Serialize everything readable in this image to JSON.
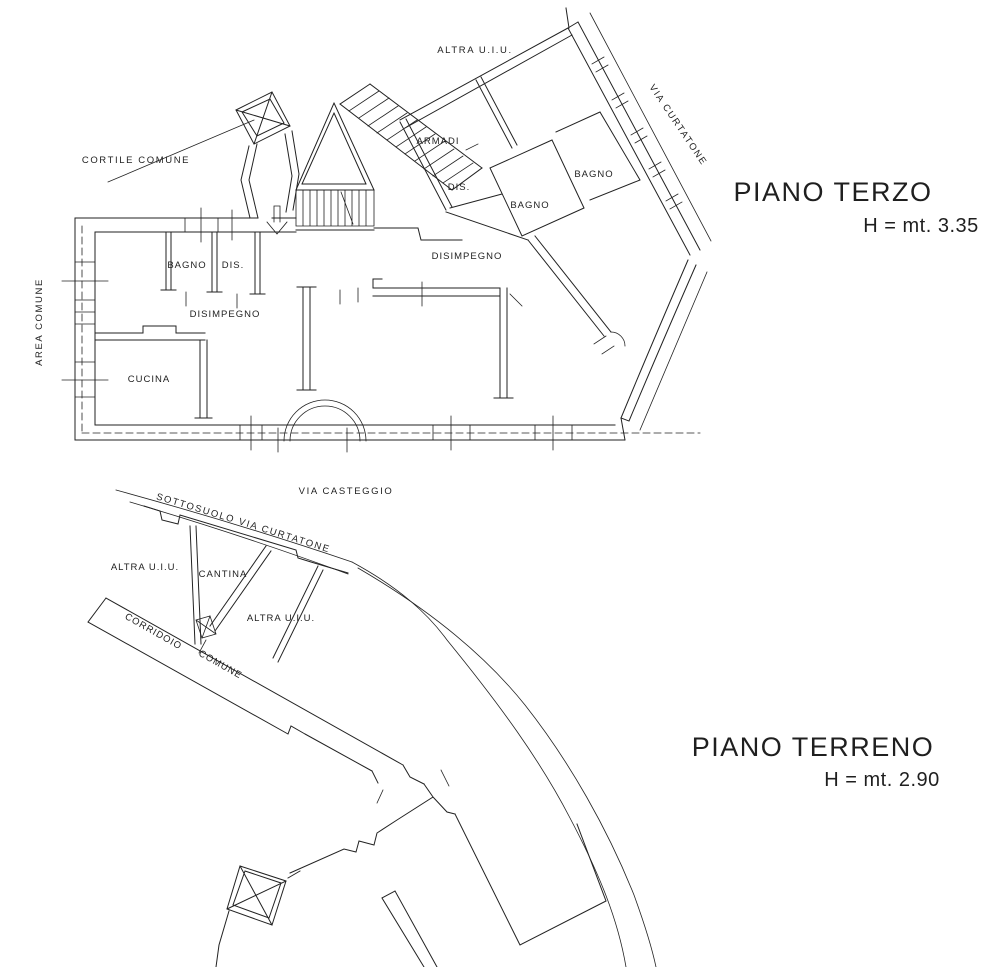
{
  "colors": {
    "background": "#ffffff",
    "ink": "#1f1f1f"
  },
  "piano_terzo": {
    "title": "PIANO TERZO",
    "height_label": "H = mt. 3.35",
    "labels": {
      "altra_uiu": "ALTRA U.I.U.",
      "via_curtatone": "VIA CURTATONE",
      "cortile_comune": "CORTILE COMUNE",
      "armadi": "ARMADI",
      "dis_right": "DIS.",
      "bagno_center": "BAGNO",
      "bagno_right": "BAGNO",
      "disimpegno_right": "DISIMPEGNO",
      "bagno_left": "BAGNO",
      "dis_left": "DIS.",
      "disimpegno_left": "DISIMPEGNO",
      "cucina": "CUCINA",
      "area_comune": "AREA COMUNE",
      "via_casteggio": "VIA CASTEGGIO"
    }
  },
  "piano_terreno": {
    "title": "PIANO TERRENO",
    "height_label": "H = mt. 2.90",
    "labels": {
      "sottosuolo_via_curtatone": "SOTTOSUOLO VIA CURTATONE",
      "altra_uiu_left": "ALTRA U.I.U.",
      "cantina": "CANTINA",
      "altra_uiu_right": "ALTRA U.I.U.",
      "corridoio": "CORRIDOIO",
      "comune": "COMUNE"
    }
  }
}
